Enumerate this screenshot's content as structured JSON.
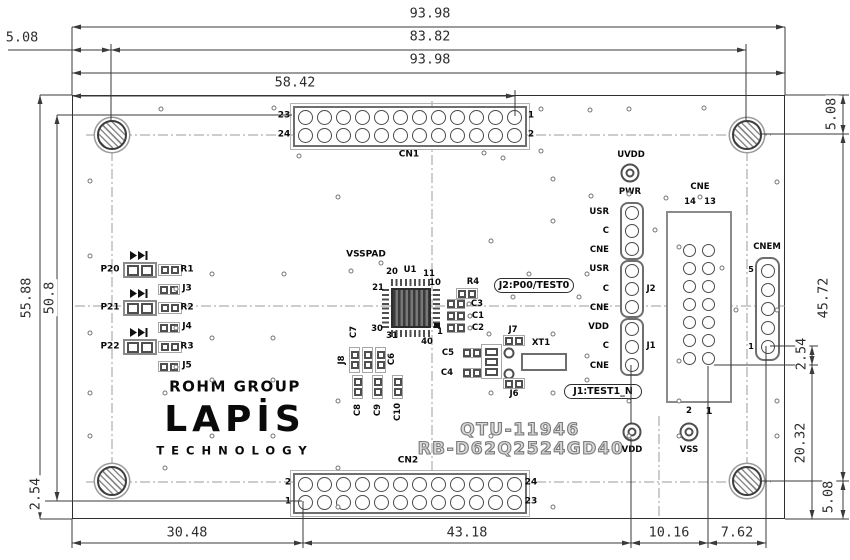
{
  "colors": {
    "dimension_line": "#3a3a3a",
    "silkscreen": "#0a0a0a",
    "outline_text": "#7a7a7a"
  },
  "dims": {
    "top1": "93.98",
    "top2": "83.82",
    "top3": "93.98",
    "top4": "58.42",
    "top_left": "5.08",
    "left1": "55.88",
    "left2": "50.8",
    "left3": "2.54",
    "right_top": "5.08",
    "right1": "45.72",
    "right2": "2.54",
    "right3": "20.32",
    "right_bottom": "5.08",
    "bottom1": "30.48",
    "bottom2": "43.18",
    "bottom3": "10.16",
    "bottom4": "7.62"
  },
  "board": {
    "cn1": {
      "ref": "CN1",
      "pin_tl": "23",
      "pin_bl": "24",
      "pin_tr": "1",
      "pin_br": "2"
    },
    "cn2": {
      "ref": "CN2",
      "pin_tl": "2",
      "pin_bl": "1",
      "pin_tr": "24",
      "pin_br": "23"
    },
    "pwr": {
      "uvdd": "UVDD",
      "label": "PWR",
      "rows": [
        "USR",
        "C",
        "CNE",
        "USR",
        "C",
        "CNE",
        "VDD",
        "C",
        "CNE"
      ],
      "j2": "J2",
      "j1": "J1"
    },
    "callout_j2": "J2:P00/TEST0",
    "callout_j1": "J1:TEST1_N",
    "cne": {
      "ref": "CNE",
      "pin14": "14",
      "pin13": "13",
      "pin2": "2",
      "pin1": "1"
    },
    "cnem": {
      "ref": "CNEM",
      "top_pin": "5",
      "bottom_pin": "1"
    },
    "pads": {
      "vdd": "VDD",
      "vss": "VSS"
    },
    "ports": {
      "p20": "P20",
      "p21": "P21",
      "p22": "P22"
    },
    "resistors": {
      "r1": "R1",
      "r2": "R2",
      "r3": "R3",
      "r4": "R4"
    },
    "jumpers": {
      "j3": "J3",
      "j4": "J4",
      "j5": "J5",
      "j6": "J6",
      "j7": "J7",
      "j8": "J8"
    },
    "caps": {
      "c1": "C1",
      "c2": "C2",
      "c3": "C3",
      "c4": "C4",
      "c5": "C5",
      "c6": "C6",
      "c7": "C7",
      "c8": "C8",
      "c9": "C9",
      "c10": "C10"
    },
    "xtal": "XT1",
    "u1": {
      "ref": "U1",
      "vsspad": "VSSPAD",
      "p20": "20",
      "p21": "21",
      "p11": "11",
      "p10": "10",
      "p30": "30",
      "p31": "31",
      "p40": "40",
      "p1": "1"
    },
    "brand": {
      "rohm": "ROHM GROUP",
      "lapis": "LAPİS",
      "tech": "TECHNOLOGY"
    },
    "id1": "QTU-11946",
    "id2": "RB-D62Q2524GD40"
  }
}
